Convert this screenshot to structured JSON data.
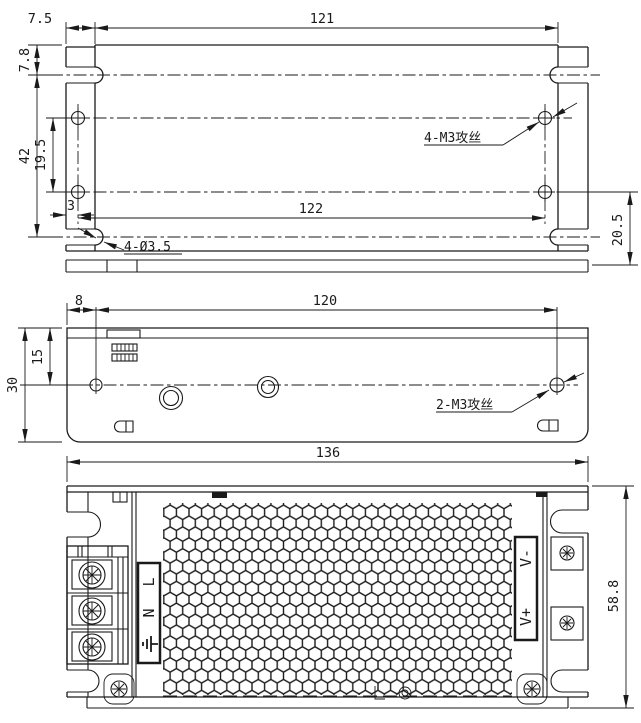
{
  "top_view": {
    "dim_flange_width": "7.5",
    "dim_body_width": "121",
    "dim_slot_offset": "7.8",
    "dim_slot_span": "42",
    "dim_hole_span_v": "19.5",
    "dim_hole_offset": "3",
    "dim_hole_span_h": "122",
    "dim_rear_offset": "20.5",
    "label_tapped_holes": "4-M3攻丝",
    "label_thru_holes": "4-Ø3.5"
  },
  "side_view": {
    "dim_hole_offset": "8",
    "dim_hole_span": "120",
    "dim_hole_height": "15",
    "dim_height": "30",
    "label_tapped_holes": "2-M3攻丝"
  },
  "front_view": {
    "dim_width": "136",
    "dim_height": "58.8",
    "terminal_live": "L",
    "terminal_neutral": "N",
    "terminal_v_minus": "V-",
    "terminal_v_plus": "V+"
  },
  "colors": {
    "line": "#1a1a1a",
    "bg": "#ffffff"
  }
}
